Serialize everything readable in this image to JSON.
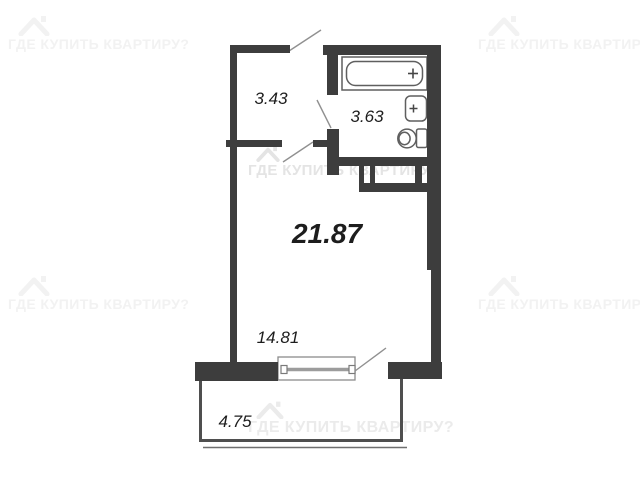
{
  "watermark": {
    "text": "ГДЕ КУПИТЬ КВАРТИРУ?",
    "logo": "house-roof-icon"
  },
  "plan": {
    "type": "apartment-floor-plan",
    "rooms": [
      {
        "name": "hallway",
        "area": "3.43"
      },
      {
        "name": "bathroom",
        "area": "3.63"
      },
      {
        "name": "studio-total-area",
        "area": "21.87"
      },
      {
        "name": "living-zone",
        "area": "14.81"
      },
      {
        "name": "balcony",
        "area": "4.75"
      }
    ],
    "fixtures": [
      "bathtub",
      "sink",
      "toilet",
      "window",
      "vent-shaft"
    ],
    "colors": {
      "wall": "#3d3d3d",
      "balcony_line": "#4f4f4f",
      "fixture_line": "#5f5f5f",
      "door_swing": "#909090",
      "label": "#1d1d1d",
      "watermark_faint": "#f2f2f2",
      "watermark_mid": "#e4e4e4"
    }
  }
}
